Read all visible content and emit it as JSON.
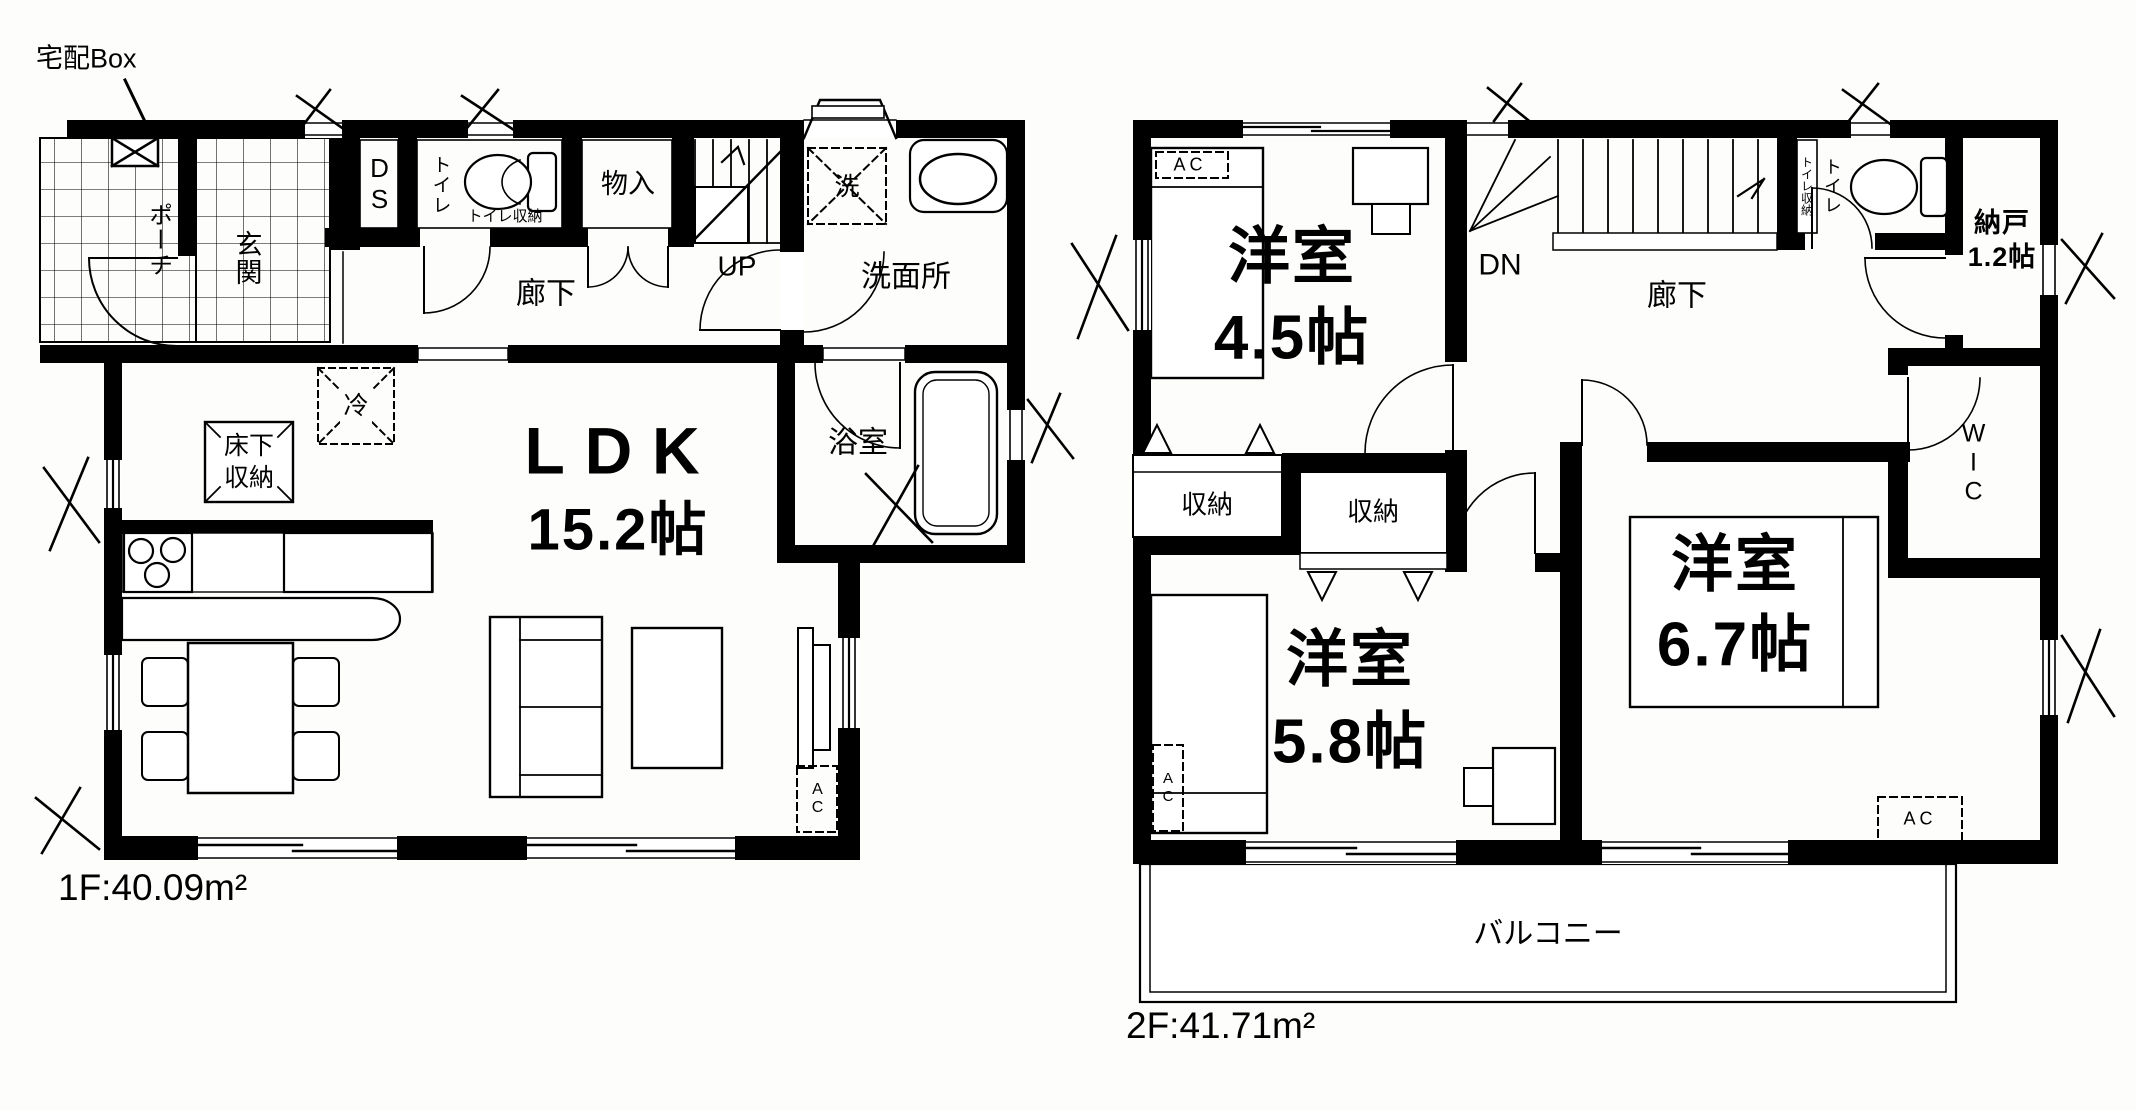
{
  "page": {
    "background": "#fdfdfc",
    "line_color": "#000000"
  },
  "floor1": {
    "area_label": "1F:40.09m²",
    "delivery_box_label": "宅配Box",
    "rooms": {
      "porch": "ポーチ",
      "entrance": "玄関",
      "ds": "DS",
      "toilet": "トイレ",
      "toilet_storage": "トイレ収納",
      "closet": "物入",
      "stairs_up": "UP",
      "hallway": "廊下",
      "washer": "洗",
      "washroom": "洗面所",
      "bathroom": "浴室",
      "ldk_line1": "LDK",
      "ldk_line2": "15.2帖",
      "fridge": "冷",
      "floor_storage_line1": "床下",
      "floor_storage_line2": "収納",
      "ac": "AC"
    }
  },
  "floor2": {
    "area_label": "2F:41.71m²",
    "rooms": {
      "bedroom45_line1": "洋室",
      "bedroom45_line2": "4.5帖",
      "ac45": "AC",
      "stairs_down": "DN",
      "hallway": "廊下",
      "toilet_storage": "トイレ収納",
      "toilet": "トイレ",
      "storeroom_line1": "納戸",
      "storeroom_line2": "1.2帖",
      "wic": "WIC",
      "closet_left": "収納",
      "closet_right": "収納",
      "bedroom58_line1": "洋室",
      "bedroom58_line2": "5.8帖",
      "ac58": "AC",
      "bedroom67_line1": "洋室",
      "bedroom67_line2": "6.7帖",
      "ac67": "AC",
      "balcony": "バルコニー"
    }
  }
}
